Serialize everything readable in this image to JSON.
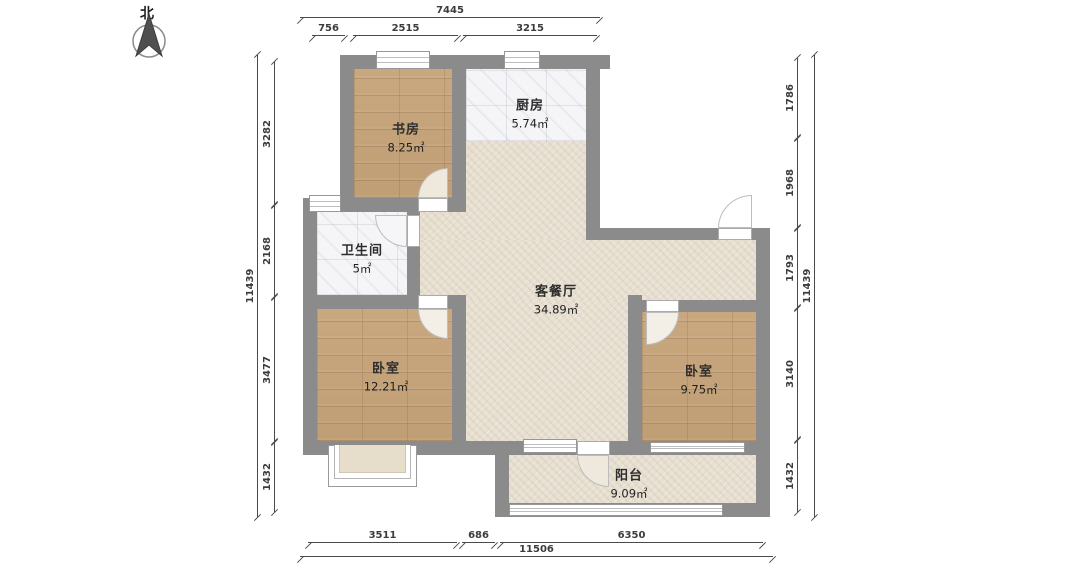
{
  "compass": {
    "label": "北"
  },
  "rooms": [
    {
      "name": "书房",
      "area": "8.25㎡"
    },
    {
      "name": "厨房",
      "area": "5.74㎡"
    },
    {
      "name": "卫生间",
      "area": "5㎡"
    },
    {
      "name": "客餐厅",
      "area": "34.89㎡"
    },
    {
      "name": "卧室",
      "area": "12.21㎡"
    },
    {
      "name": "卧室",
      "area": "9.75㎡"
    },
    {
      "name": "阳台",
      "area": "9.09㎡"
    }
  ],
  "dimensions": {
    "top": {
      "total": "7445",
      "segments": [
        "756",
        "2515",
        "3215"
      ]
    },
    "left": {
      "total": "11439",
      "segments": [
        "3282",
        "2168",
        "3477",
        "1432"
      ]
    },
    "right": {
      "total": "11439",
      "segments": [
        "1786",
        "1968",
        "1793",
        "3140",
        "1432"
      ]
    },
    "bottom": {
      "total": "11506",
      "segments": [
        "3511",
        "686",
        "6350"
      ]
    }
  },
  "colors": {
    "wall": "#8b8b8b",
    "wood_floor": "#c9a87c",
    "white_tile": "#f5f5f7",
    "beige_tile": "#e7dfd0",
    "dimension_line": "#4a4a4a",
    "background": "#ffffff"
  }
}
